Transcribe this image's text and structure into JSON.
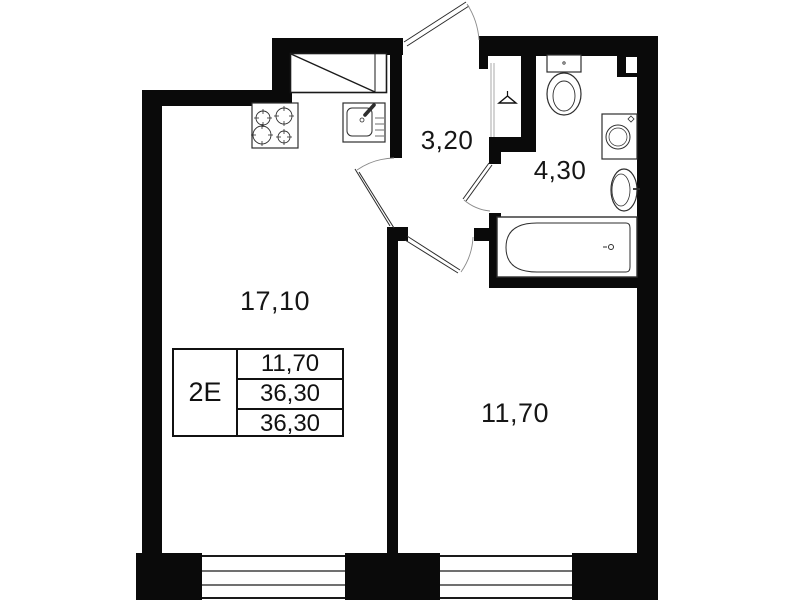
{
  "plan": {
    "title": "apartment-floor-plan",
    "colors": {
      "wall": "#0a0a0a",
      "background": "#ffffff",
      "fixture_line": "#333333",
      "arc_line": "#8a8a8a"
    },
    "rooms": {
      "living_kitchen": {
        "name": "living-room-kitchen",
        "area": "17,10"
      },
      "hallway": {
        "name": "hallway",
        "area": "3,20"
      },
      "bathroom": {
        "name": "bathroom",
        "area": "4,30"
      },
      "bedroom": {
        "name": "bedroom",
        "area": "11,70"
      }
    },
    "legend": {
      "apartment_type": "2E",
      "values": [
        "11,70",
        "36,30",
        "36,30"
      ]
    },
    "fixtures": [
      "stove-icon",
      "kitchen-sink-icon",
      "vent-shaft-icon",
      "toilet-icon",
      "washing-machine-icon",
      "bathroom-sink-icon",
      "bathtub-icon",
      "hanger-icon"
    ],
    "doors": [
      "entrance-door",
      "living-room-door",
      "bathroom-door",
      "bedroom-door"
    ],
    "windows": [
      "window-living-room",
      "window-bedroom"
    ]
  }
}
